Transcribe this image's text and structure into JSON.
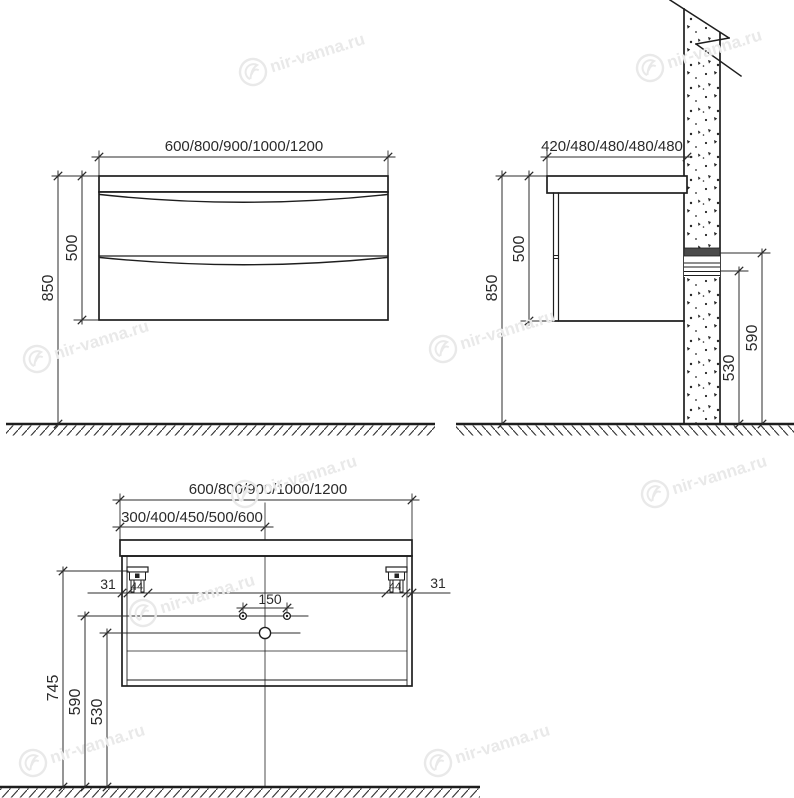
{
  "watermark": {
    "text": "nir-vanna.ru"
  },
  "views": {
    "front": {
      "width": "600/800/900/1000/1200",
      "cabinet_height": "500",
      "mount_height": "850"
    },
    "side": {
      "depth": "420/480/480/480/480",
      "cabinet_height": "500",
      "mount_height": "850",
      "rail_height": "590",
      "rail_bottom_height": "530"
    },
    "rear": {
      "width": "600/800/900/1000/1200",
      "bowl_center": "300/400/450/500/600",
      "edge_offset_left": "31",
      "edge_offset_right": "31",
      "bracket_width_left": "44",
      "bracket_width_right": "44",
      "faucet_spacing": "150",
      "bracket_height": "745",
      "supply_height": "590",
      "drain_height": "530"
    }
  }
}
